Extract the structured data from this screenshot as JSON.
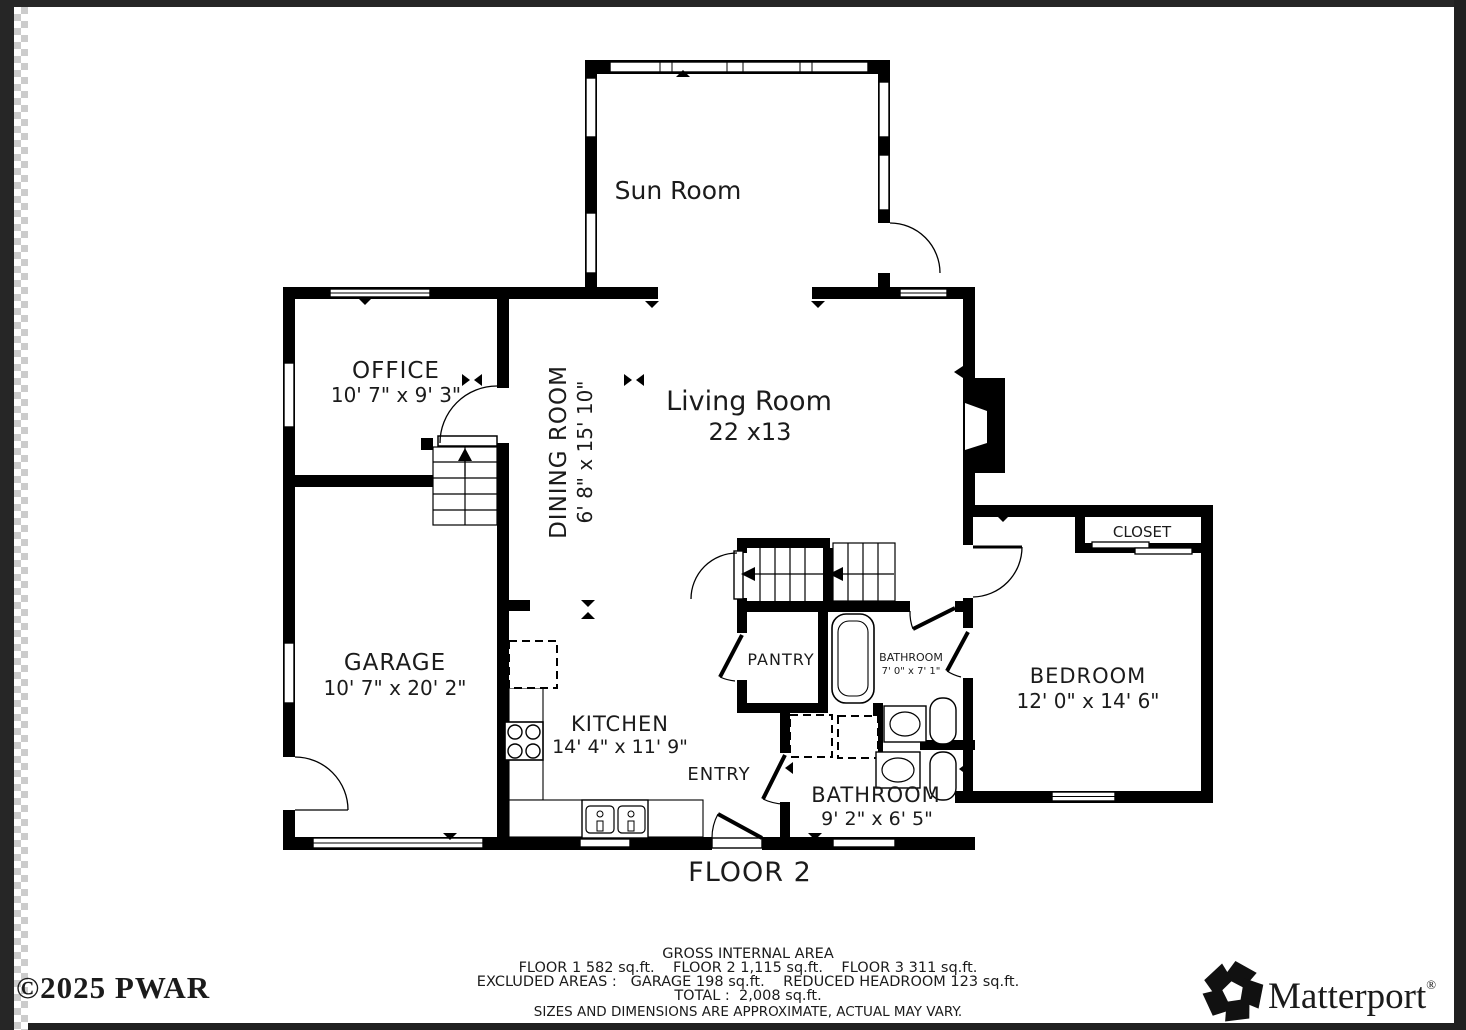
{
  "plan": {
    "floor_label": "FLOOR 2",
    "rooms": {
      "sun_room": {
        "label": "Sun Room"
      },
      "office": {
        "label": "OFFICE",
        "dims": "10' 7\" x 9' 3\""
      },
      "dining_room": {
        "label": "DINING ROOM",
        "dims": "6' 8\" x 15' 10\""
      },
      "living_room": {
        "label": "Living Room",
        "dims": "22 x13"
      },
      "garage": {
        "label": "GARAGE",
        "dims": "10' 7\" x 20' 2\""
      },
      "kitchen": {
        "label": "KITCHEN",
        "dims": "14' 4\" x 11' 9\""
      },
      "entry": {
        "label": "ENTRY"
      },
      "pantry": {
        "label": "PANTRY"
      },
      "bathroom_small": {
        "label": "BATHROOM",
        "dims": "7' 0\" x 7' 1\""
      },
      "bathroom_main": {
        "label": "BATHROOM",
        "dims": "9' 2\" x 6' 5\""
      },
      "bedroom": {
        "label": "BEDROOM",
        "dims": "12' 0\" x 14' 6\""
      },
      "closet": {
        "label": "CLOSET"
      }
    }
  },
  "footer": {
    "title": "GROSS INTERNAL AREA",
    "line_floors": "FLOOR 1 582 sq.ft.    FLOOR 2 1,115 sq.ft.    FLOOR 3 311 sq.ft.",
    "line_excluded": "EXCLUDED AREAS :   GARAGE 198 sq.ft.    REDUCED HEADROOM 123 sq.ft.",
    "line_total": "TOTAL :  2,008 sq.ft.",
    "disclaimer": "SIZES AND DIMENSIONS ARE APPROXIMATE, ACTUAL MAY VARY."
  },
  "branding": {
    "copyright": "©2025 PWAR",
    "logo_text": "Matterport",
    "logo_reg": "®"
  },
  "colors": {
    "wall": "#000000",
    "disclaimer_gray": "#8f8f8f",
    "edge_dark": "#262626",
    "checker_gray": "#cccccc"
  }
}
